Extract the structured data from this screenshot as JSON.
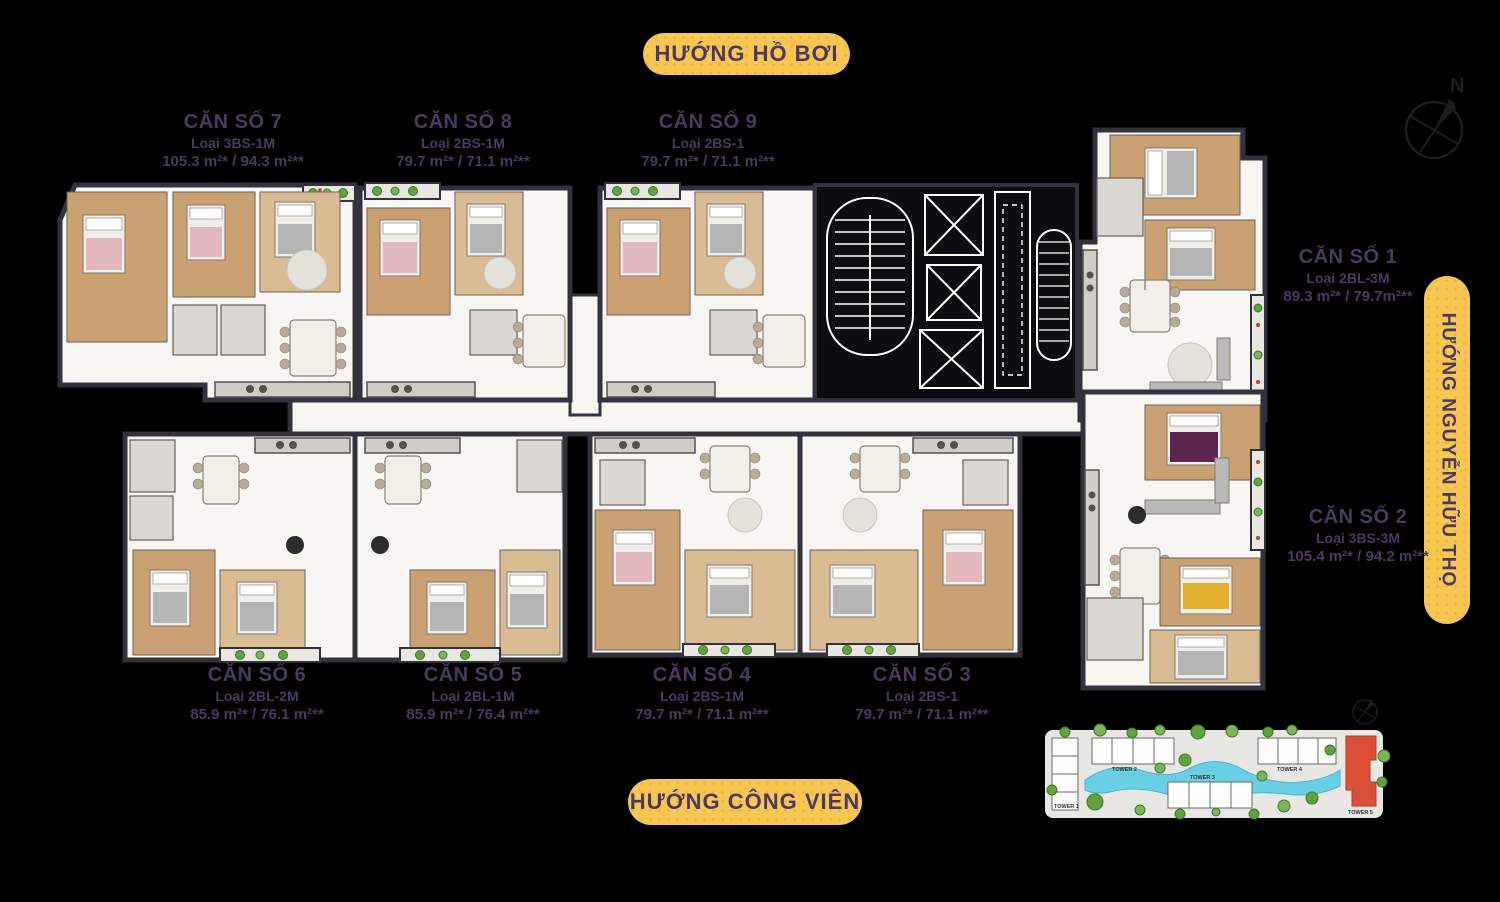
{
  "badges": {
    "top": "HƯỚNG HỒ BƠI",
    "bottom": "HƯỚNG CÔNG VIÊN",
    "right": "HƯỚNG NGUYỄN HỮU THỌ",
    "bg_color": "#F8C752",
    "text_color": "#4B3960"
  },
  "compass": {
    "north_label": "N"
  },
  "units": [
    {
      "id": 1,
      "name": "CĂN SỐ 1",
      "type": "Loại 2BL-3M",
      "area": "89.3 m²* / 79.7m²**"
    },
    {
      "id": 2,
      "name": "CĂN SỐ 2",
      "type": "Loại 3BS-3M",
      "area": "105.4 m²* / 94.2 m²**"
    },
    {
      "id": 3,
      "name": "CĂN SỐ 3",
      "type": "Loại 2BS-1",
      "area": "79.7 m²* / 71.1 m²**"
    },
    {
      "id": 4,
      "name": "CĂN SỐ 4",
      "type": "Loại 2BS-1M",
      "area": "79.7 m²* / 71.1 m²**"
    },
    {
      "id": 5,
      "name": "CĂN SỐ 5",
      "type": "Loại 2BL-1M",
      "area": "85.9 m²* / 76.4 m²**"
    },
    {
      "id": 6,
      "name": "CĂN SỐ 6",
      "type": "Loại 2BL-2M",
      "area": "85.9 m²* / 76.1 m²**"
    },
    {
      "id": 7,
      "name": "CĂN SỐ 7",
      "type": "Loại 3BS-1M",
      "area": "105.3 m²* / 94.3 m²**"
    },
    {
      "id": 8,
      "name": "CĂN SỐ 8",
      "type": "Loại 2BS-1M",
      "area": "79.7 m²* / 71.1 m²**"
    },
    {
      "id": 9,
      "name": "CĂN SỐ 9",
      "type": "Loại 2BS-1",
      "area": "79.7 m²* / 71.1 m²**"
    }
  ],
  "site_plan": {
    "towers": [
      "TOWER 1",
      "TOWER 2",
      "TOWER 3",
      "TOWER 4",
      "TOWER 5"
    ],
    "highlighted_tower": "TOWER 5",
    "highlight_color": "#DD4F38",
    "water_color": "#69CFE4",
    "ground_color": "#E8E7E4"
  }
}
